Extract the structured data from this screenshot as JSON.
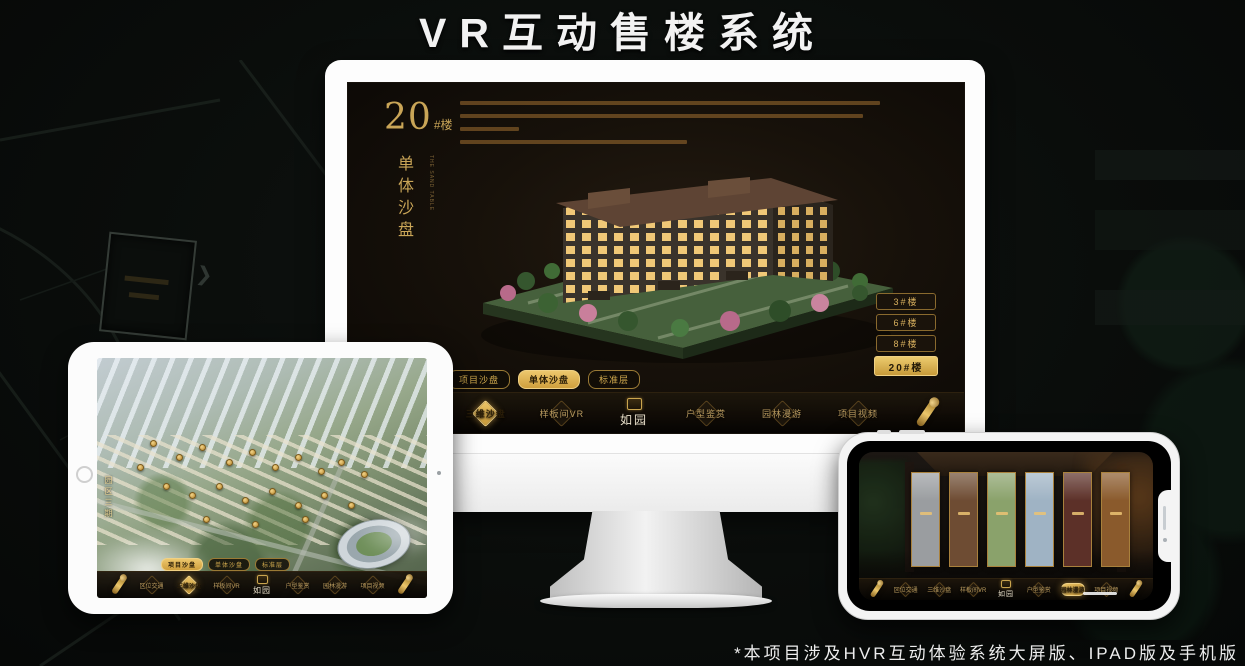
{
  "page": {
    "title": "VR互动售楼系统",
    "footnote": "*本项目涉及HVR互动体验系统大屏版、IPAD版及手机版"
  },
  "colors": {
    "gold": "#c9a24b",
    "gold_bright": "#ecc568",
    "screen_dark": "#17110a",
    "title_white": "#f2f2f2"
  },
  "monitor_app": {
    "badge_number": "20",
    "badge_suffix": "#楼",
    "subtitle_vertical": "单体沙盘",
    "subtitle_en": "THE SAND TABLE",
    "description_line_widths_pct": [
      100,
      96,
      14,
      54
    ],
    "floor_buttons": [
      {
        "label": "3#楼",
        "active": false
      },
      {
        "label": "6#楼",
        "active": false
      },
      {
        "label": "8#楼",
        "active": false
      },
      {
        "label": "20#楼",
        "active": true
      }
    ],
    "sub_tabs": [
      {
        "label": "项目沙盘",
        "active": false
      },
      {
        "label": "单体沙盘",
        "active": true
      },
      {
        "label": "标准层",
        "active": false
      }
    ],
    "nav_left": [
      {
        "label": "区位交通",
        "active": false
      },
      {
        "label": "三维沙盘",
        "active": true
      },
      {
        "label": "样板间VR",
        "active": false
      }
    ],
    "nav_right": [
      {
        "label": "户型鉴赏",
        "active": false
      },
      {
        "label": "园林漫游",
        "active": false
      },
      {
        "label": "项目视频",
        "active": false
      }
    ],
    "logo_text": "如园"
  },
  "ipad_app": {
    "area_label_vertical": "园区三期",
    "sub_tabs": [
      {
        "label": "项目沙盘",
        "active": true
      },
      {
        "label": "单体沙盘",
        "active": false
      },
      {
        "label": "标准层",
        "active": false
      }
    ],
    "nav_left": [
      {
        "label": "区位交通",
        "active": false
      },
      {
        "label": "三维沙盘",
        "active": true
      },
      {
        "label": "样板间VR",
        "active": false
      }
    ],
    "nav_right": [
      {
        "label": "户型鉴赏",
        "active": false
      },
      {
        "label": "园林漫游",
        "active": false
      },
      {
        "label": "项目视频",
        "active": false
      }
    ],
    "logo_text": "如园"
  },
  "phone_app": {
    "gallery_panels": [
      {
        "tone": "#9a9da0"
      },
      {
        "tone": "#6e4c33"
      },
      {
        "tone": "#8aa26b"
      },
      {
        "tone": "#9fb3c4"
      },
      {
        "tone": "#5c3028"
      },
      {
        "tone": "#8a5a2c"
      }
    ],
    "nav_left": [
      {
        "label": "区位交通",
        "active": false
      },
      {
        "label": "三维沙盘",
        "active": false
      },
      {
        "label": "样板间VR",
        "active": false
      }
    ],
    "nav_right": [
      {
        "label": "户型鉴赏",
        "active": false
      },
      {
        "label": "园林漫游",
        "active": true
      },
      {
        "label": "项目视频",
        "active": false
      }
    ],
    "logo_text": "如园"
  }
}
